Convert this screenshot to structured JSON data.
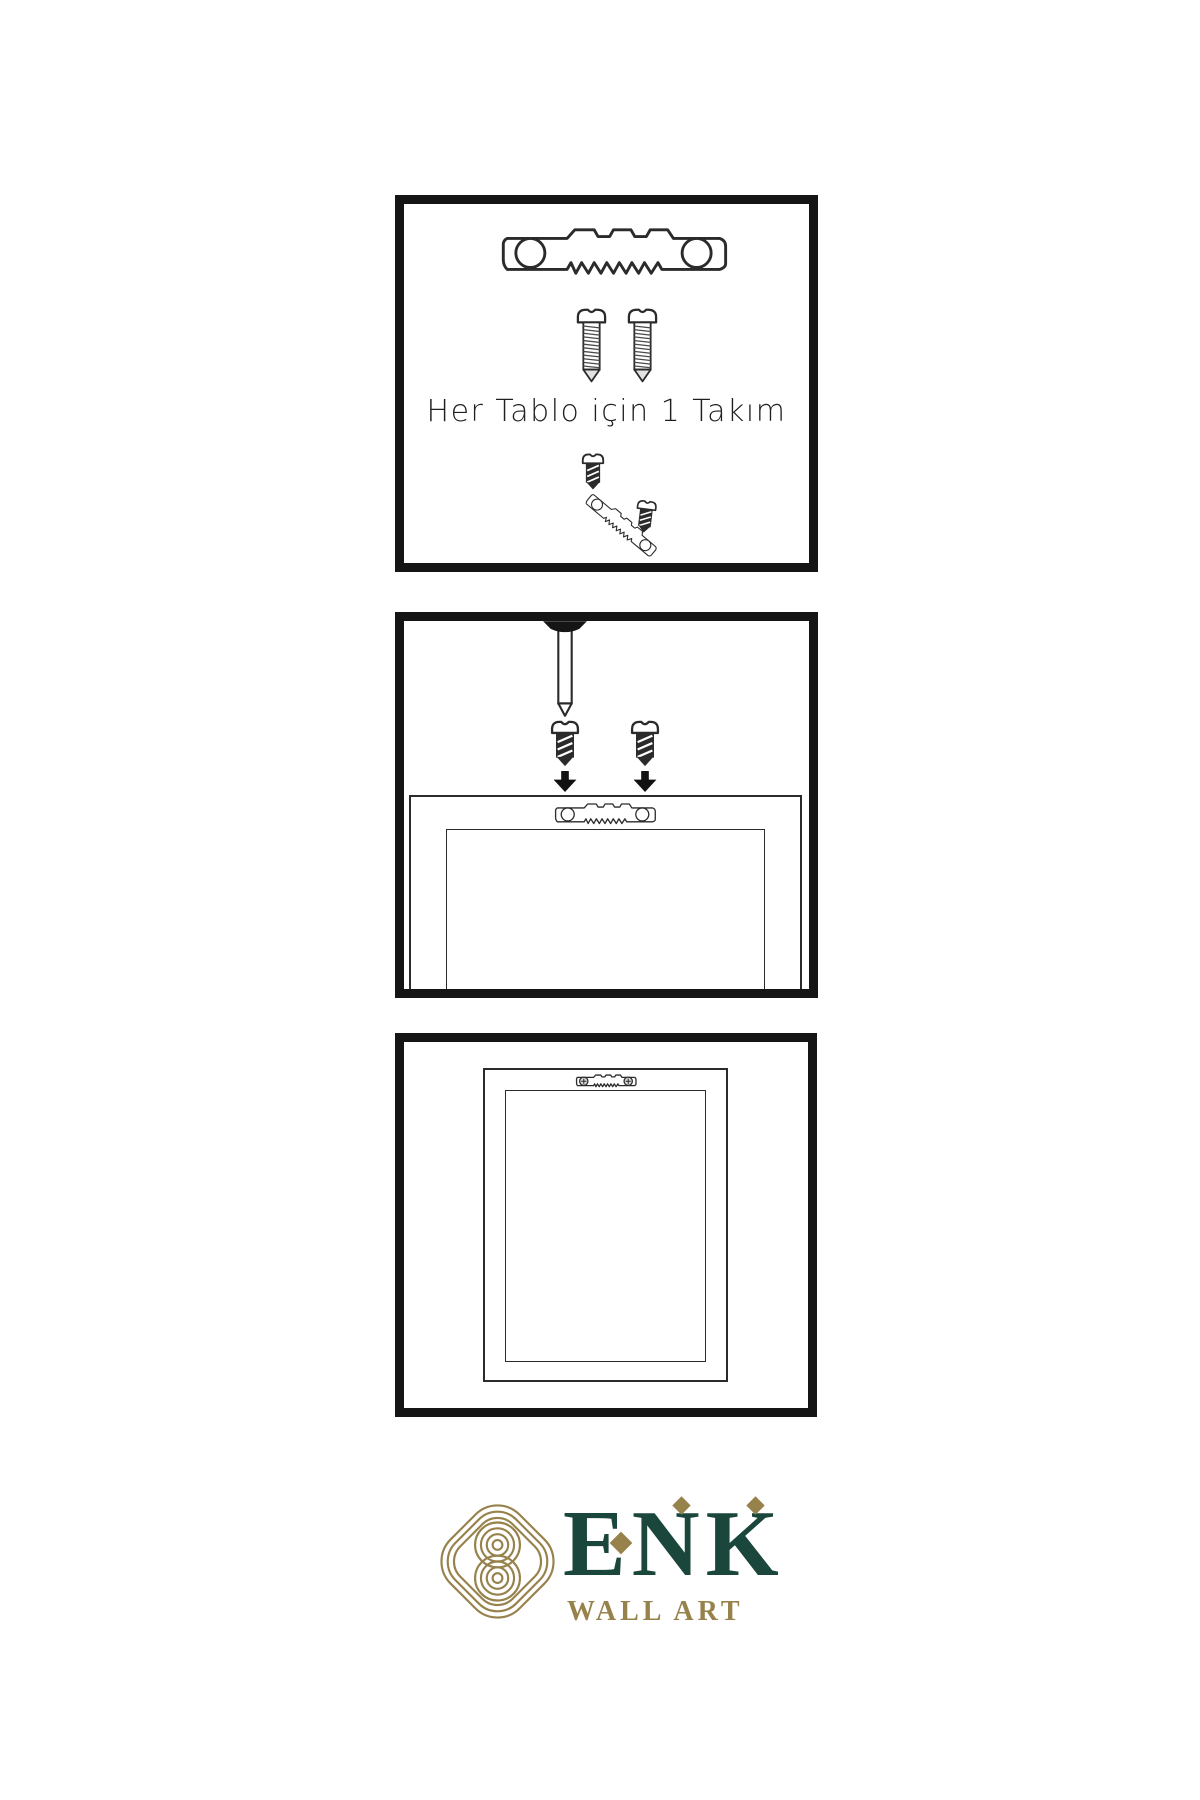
{
  "page": {
    "background": "#ffffff",
    "line_color": "#2b2b2b",
    "panel_border_color": "#151515"
  },
  "panels": [
    {
      "step": 1,
      "caption": "Her Tablo için 1 Takım",
      "items": [
        "sawtooth-hanger",
        "screw",
        "screw",
        "screw-into-hanger-assembly",
        "screw"
      ]
    },
    {
      "step": 2,
      "caption": "",
      "items": [
        "wall-nail",
        "screw",
        "screw",
        "arrow-down",
        "arrow-down",
        "frame-back-with-sawtooth-hanger"
      ]
    },
    {
      "step": 3,
      "caption": "",
      "items": [
        "hanging-frame-with-mounted-sawtooth-hanger"
      ]
    }
  ],
  "logo": {
    "mark": "celtic-knot",
    "brand": "ENK",
    "tagline": "WALL ART",
    "colors": {
      "green": "#1b463b",
      "gold": "#97824c"
    }
  }
}
